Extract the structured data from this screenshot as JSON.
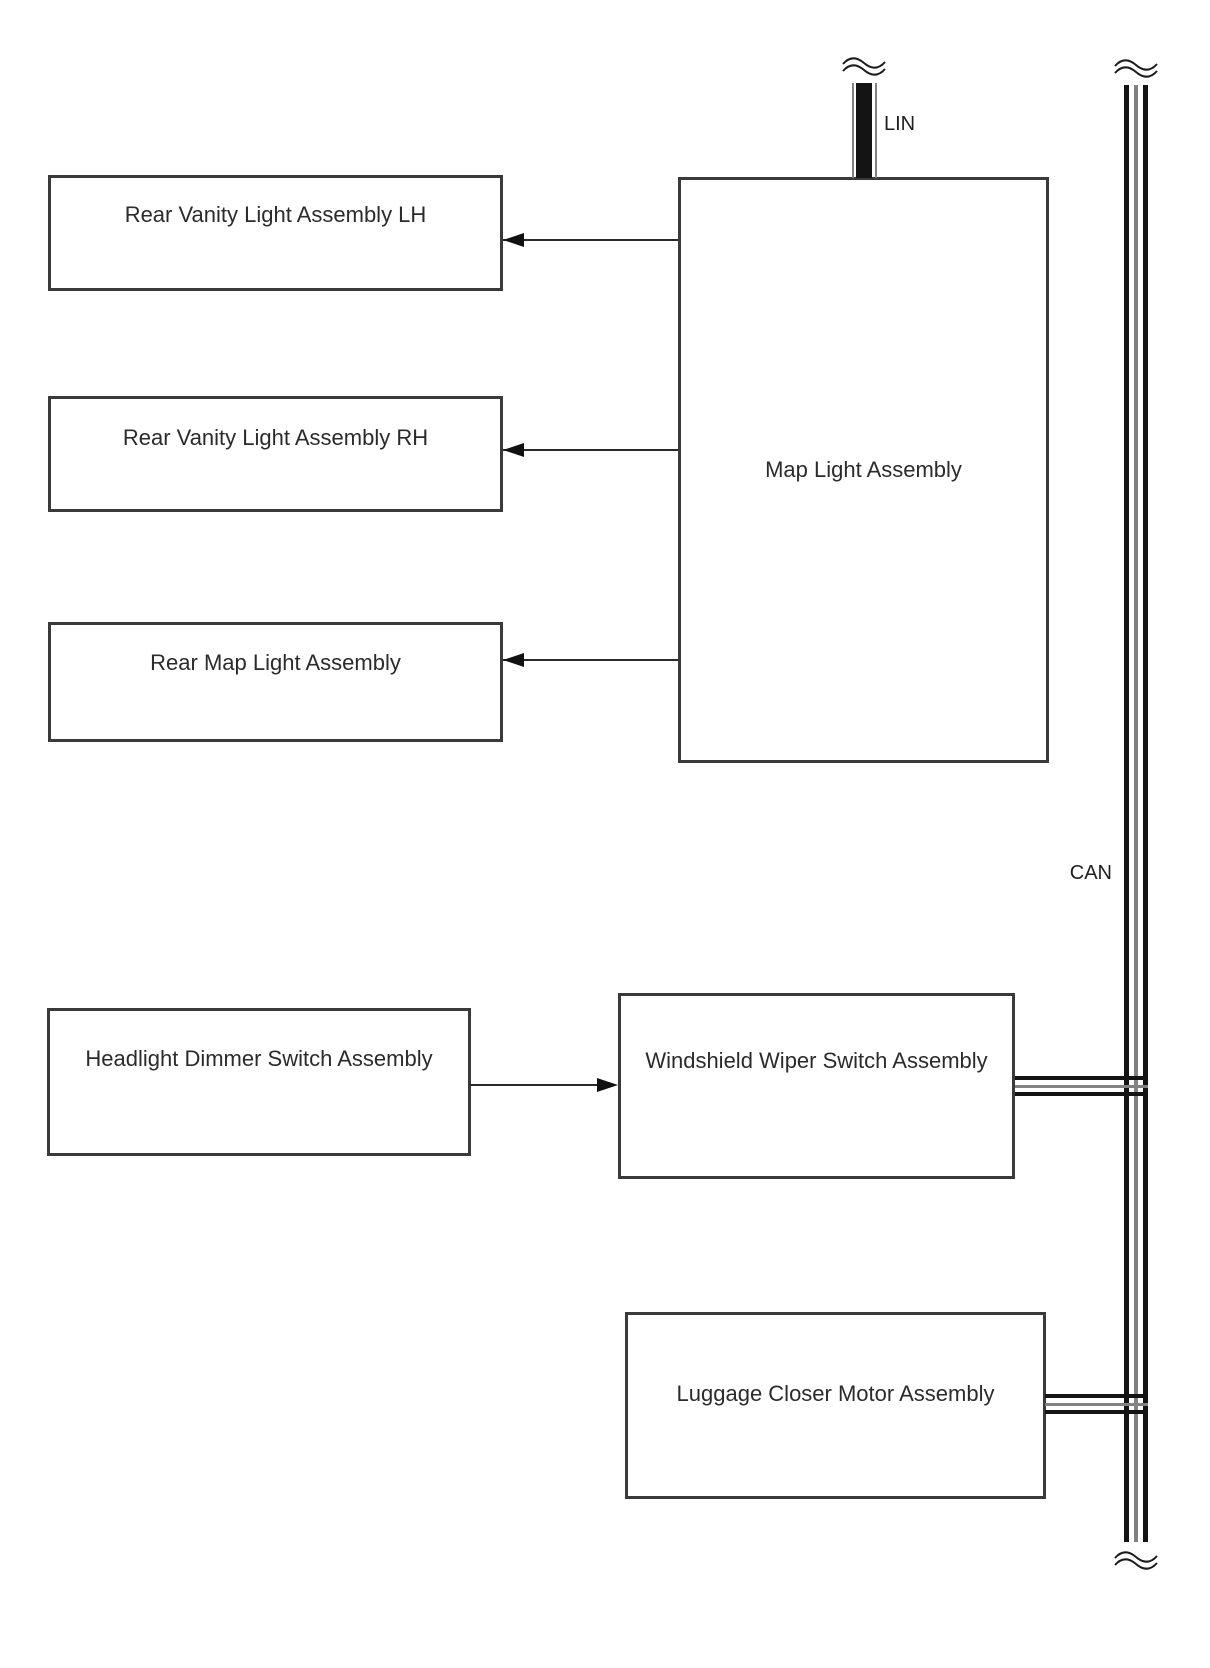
{
  "boxes": {
    "rear_vanity_lh": {
      "label": "Rear Vanity Light Assembly LH"
    },
    "rear_vanity_rh": {
      "label": "Rear Vanity Light Assembly RH"
    },
    "rear_map": {
      "label": "Rear Map Light Assembly"
    },
    "map_light": {
      "label": "Map Light Assembly"
    },
    "headlight_dimmer": {
      "label": "Headlight Dimmer Switch Assembly"
    },
    "windshield_wiper": {
      "label": "Windshield Wiper Switch Assembly"
    },
    "luggage_closer": {
      "label": "Luggage Closer Motor Assembly"
    }
  },
  "bus_labels": {
    "lin": "LIN",
    "can": "CAN"
  },
  "colors": {
    "background": "#ffffff",
    "box_border": "#3a3a3a",
    "line_black": "#141414",
    "line_gray": "#828282",
    "text": "#2b2b2b"
  }
}
